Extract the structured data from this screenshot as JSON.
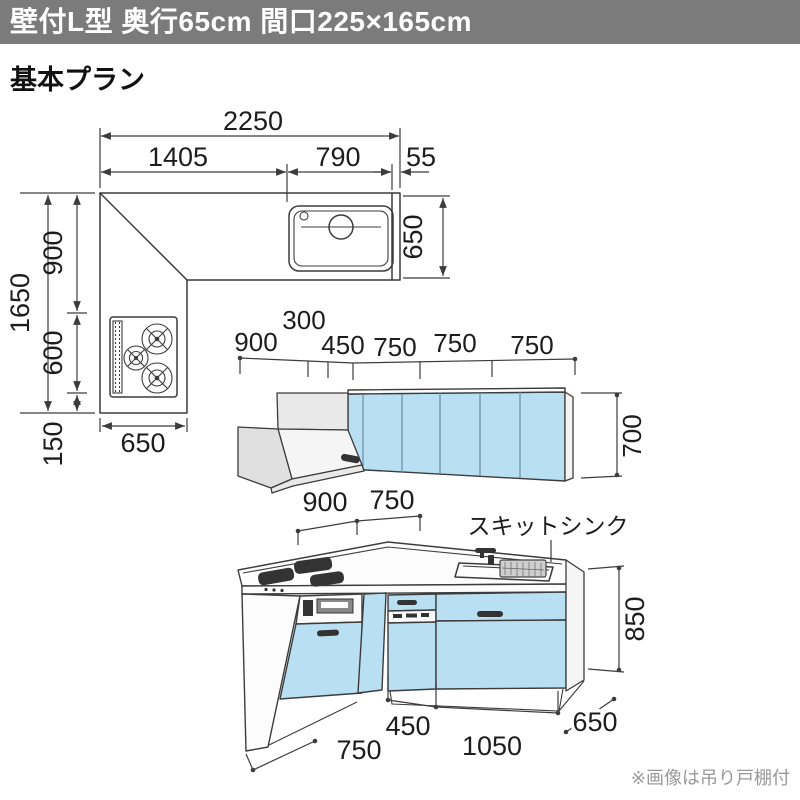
{
  "header": {
    "title": "壁付L型 奥行65cm 間口225×165cm"
  },
  "page": {
    "subtitle": "基本プラン",
    "footnote": "※画像は吊り戸棚付"
  },
  "colors": {
    "header_bg": "#7b7b7b",
    "header_fg": "#ffffff",
    "cabinet_blue": "#b9dff2",
    "line": "#3c3c3c",
    "note_gray": "#999999",
    "panel_gray": "#e9e9e9"
  },
  "plan_view": {
    "dim_width_total": "2250",
    "dim_width_left": "1405",
    "dim_width_sink": "790",
    "dim_width_end": "55",
    "dim_depth_total": "1650",
    "dim_depth_upper": "900",
    "dim_depth_mid": "600",
    "dim_depth_lower": "150",
    "dim_leg_width": "650",
    "dim_counter_depth": "650"
  },
  "wall_elevation": {
    "dim_hood": "900",
    "dim_corner": "300",
    "dim_corner_door": "450",
    "dim_door1": "750",
    "dim_door2": "750",
    "dim_door3": "750",
    "dim_cabinet_height": "700"
  },
  "base_elevation": {
    "dim_back_left": "900",
    "dim_back_right": "750",
    "sink_label": "スキットシンク",
    "dim_height": "850",
    "dim_depth": "650",
    "dim_unit_small": "450",
    "dim_unit_large": "1050",
    "dim_leg_depth": "750"
  }
}
